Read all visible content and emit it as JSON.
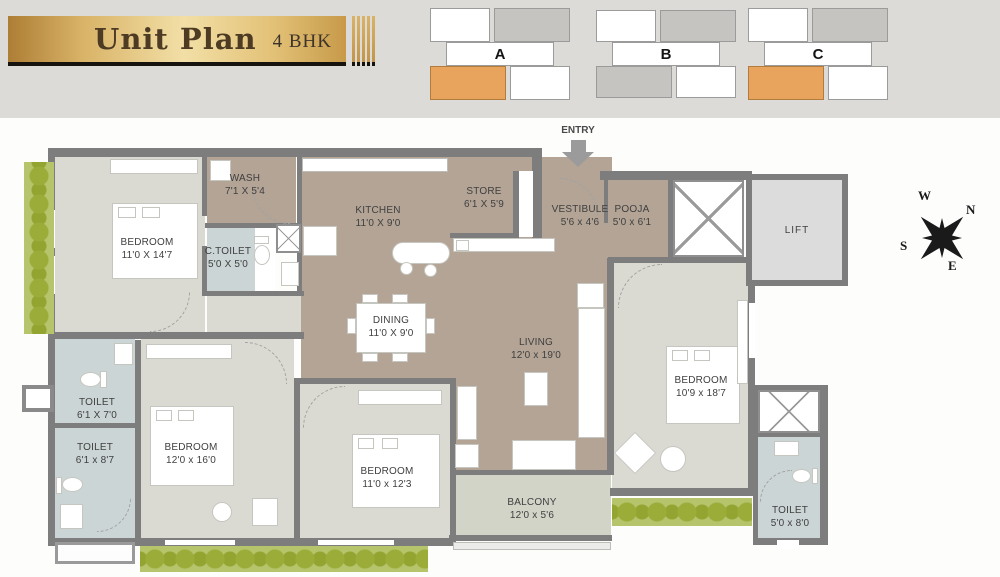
{
  "banner": {
    "title": "Unit Plan",
    "subtitle": "4 BHK"
  },
  "key_plans": [
    {
      "label": "A"
    },
    {
      "label": "B"
    },
    {
      "label": "C"
    }
  ],
  "entry": {
    "label": "ENTRY"
  },
  "compass": {
    "w": "W",
    "n": "N",
    "s": "S",
    "e": "E"
  },
  "rooms": {
    "bedroom1": {
      "name": "BEDROOM",
      "dims": "11'0 X 14'7"
    },
    "wash": {
      "name": "WASH",
      "dims": "7'1 X 5'4"
    },
    "ctoilet": {
      "name": "C.TOILET",
      "dims": "5'0 X 5'0"
    },
    "kitchen": {
      "name": "KITCHEN",
      "dims": "11'0 X 9'0"
    },
    "store": {
      "name": "STORE",
      "dims": "6'1 X 5'9"
    },
    "vestibule": {
      "name": "VESTIBULE",
      "dims": "5'6 x 4'6"
    },
    "pooja": {
      "name": "POOJA",
      "dims": "5'0 x 6'1"
    },
    "lift": {
      "name": "LIFT"
    },
    "dining": {
      "name": "DINING",
      "dims": "11'0 X 9'0"
    },
    "living": {
      "name": "LIVING",
      "dims": "12'0 x 19'0"
    },
    "toilet1": {
      "name": "TOILET",
      "dims": "6'1 X 7'0"
    },
    "toilet2": {
      "name": "TOILET",
      "dims": "6'1 x 8'7"
    },
    "bedroom2": {
      "name": "BEDROOM",
      "dims": "12'0 x 16'0"
    },
    "bedroom3": {
      "name": "BEDROOM",
      "dims": "11'0 x 12'3"
    },
    "balcony": {
      "name": "BALCONY",
      "dims": "12'0 x 5'6"
    },
    "bedroom4": {
      "name": "BEDROOM",
      "dims": "10'9 x 18'7"
    },
    "toilet3": {
      "name": "TOILET",
      "dims": "5'0 x 8'0"
    }
  },
  "colors": {
    "wall": "#7d7d7d",
    "floor_taupe": "#b3a496",
    "floor_bedroom": "#dbdad2",
    "floor_toilet": "#ccd5d5",
    "floor_balcony": "#d2d4c8",
    "hedge_green": "#9cac39",
    "keyplan_orange": "#e8a45c",
    "banner_gold": "#d9b367"
  }
}
